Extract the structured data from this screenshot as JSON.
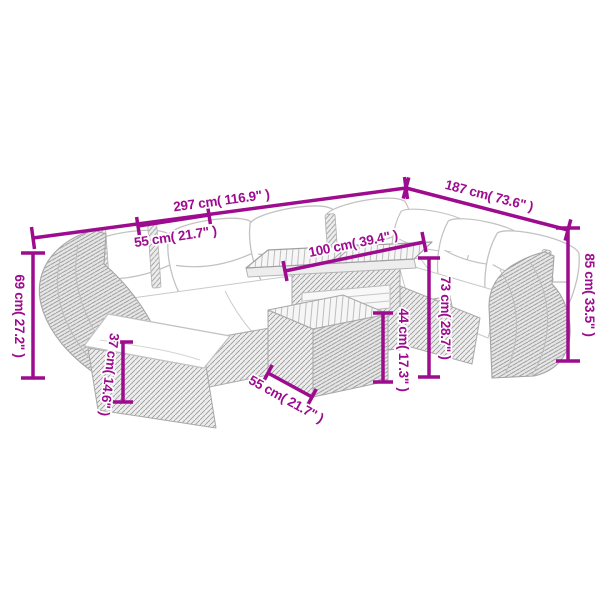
{
  "diagram": {
    "type": "product-dimension-diagram",
    "subject": "9-piece rattan garden lounge set with cushions, footstool and slatted-top table (line art)",
    "background_color": "#ffffff",
    "accent_color": "#9d0c8e",
    "furniture_line_color": "#bdbdbd",
    "dimensions": [
      {
        "id": "overall-width",
        "label": "297 cm( 116.9\" )"
      },
      {
        "id": "overall-depth",
        "label": "187 cm( 73.6\" )"
      },
      {
        "id": "seat-module-width",
        "label": "55 cm( 21.7\" )"
      },
      {
        "id": "table-length",
        "label": "100 cm( 39.4\" )"
      },
      {
        "id": "left-arm-height",
        "label": "69 cm( 27.2\" )"
      },
      {
        "id": "back-height",
        "label": "85 cm( 33.5\" )"
      },
      {
        "id": "table-total-height",
        "label": "73 cm( 28.7\" )"
      },
      {
        "id": "table-lower-height",
        "label": "44 cm( 17.3\" )"
      },
      {
        "id": "footstool-height",
        "label": "37 cm( 14.6\" )"
      },
      {
        "id": "table-depth",
        "label": "55 cm( 21.7\" )"
      }
    ]
  }
}
